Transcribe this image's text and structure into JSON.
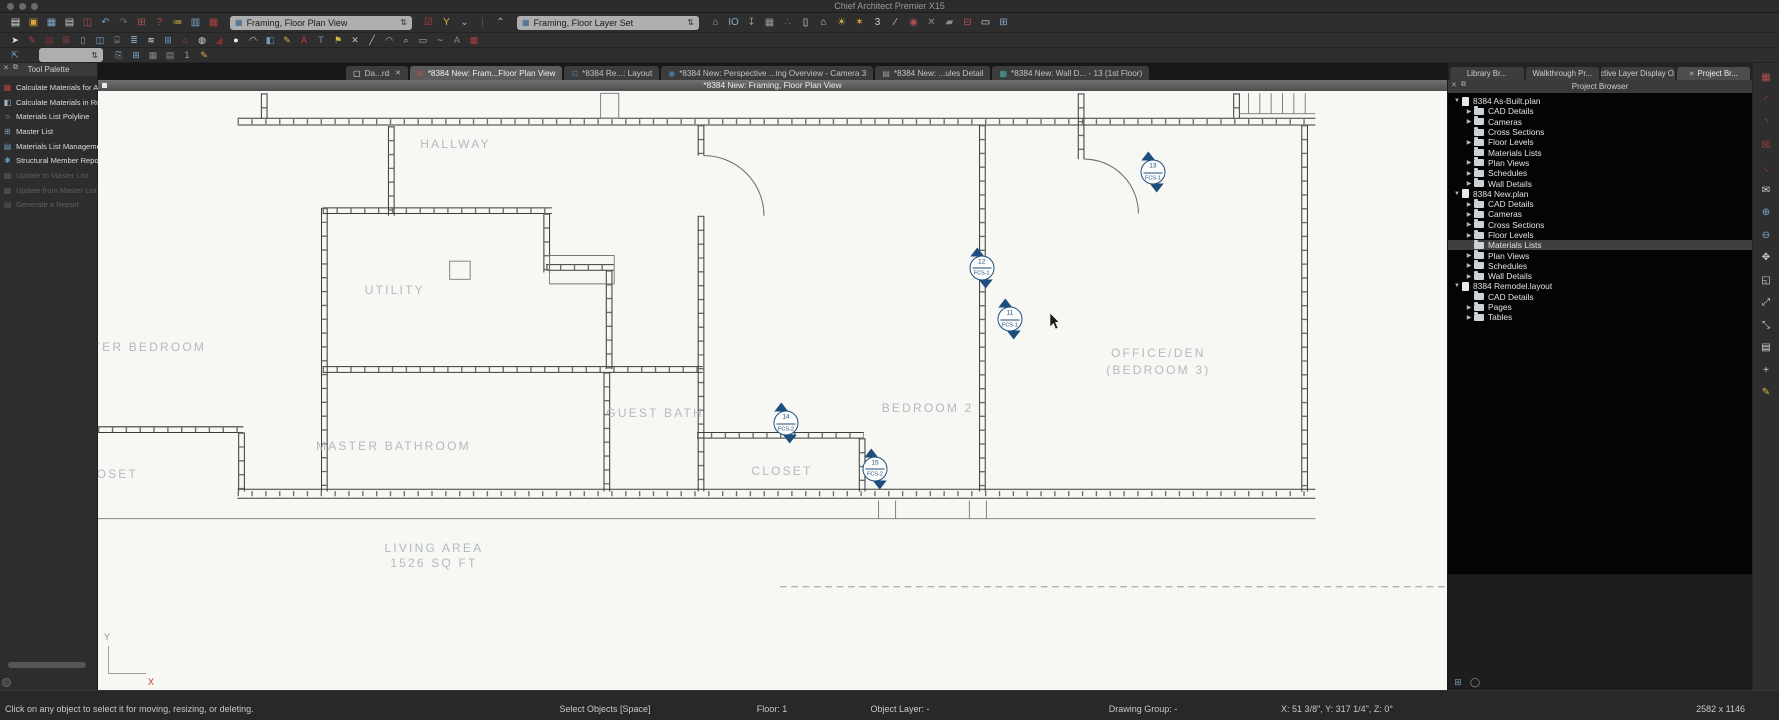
{
  "window": {
    "title": "Chief Architect Premier X15"
  },
  "toolbar": {
    "plan_view_select": "Framing, Floor Plan View",
    "layer_set_select": "Framing, Floor Layer Set",
    "row1a": [
      {
        "n": "new-plan-icon",
        "c": "#e6e6e6",
        "g": "▤"
      },
      {
        "n": "open-plan-icon",
        "c": "#d9a33c",
        "g": "▣"
      },
      {
        "n": "save-icon",
        "c": "#7fa8c9",
        "g": "▦"
      },
      {
        "n": "print-icon",
        "c": "#c9c9c9",
        "g": "▤"
      },
      {
        "n": "export-dialog-icon",
        "c": "#b05050",
        "g": "◫"
      },
      {
        "n": "undo-icon",
        "c": "#6f9cbf",
        "g": "↶"
      },
      {
        "n": "redo-icon",
        "c": "#6b6b6b",
        "g": "↷"
      },
      {
        "n": "layout-pages-icon",
        "c": "#b05050",
        "g": "⊞"
      },
      {
        "n": "help-icon",
        "c": "#c04040",
        "g": "?"
      },
      {
        "n": "materials-list-icon",
        "c": "#d9b44a",
        "g": "≔"
      },
      {
        "n": "components-icon",
        "c": "#7fa8c9",
        "g": "▥"
      },
      {
        "n": "ruby-report-icon",
        "c": "#b04040",
        "g": "▦"
      }
    ],
    "row1b": [
      {
        "n": "plan-check-icon",
        "c": "#c04040",
        "g": "☑"
      },
      {
        "n": "settings-wrench-icon",
        "c": "#d9b44a",
        "g": "Y"
      },
      {
        "n": "chevron-down-icon",
        "c": "#9fb6c9",
        "g": "⌄"
      },
      {
        "n": "toolbar-divider",
        "c": "#555555",
        "g": "|"
      },
      {
        "n": "chevron-up-icon",
        "c": "#9fb6c9",
        "g": "⌃"
      }
    ],
    "row1c": [
      {
        "n": "reference-display-icon",
        "c": "#7fa8c9",
        "g": "⌂"
      },
      {
        "n": "io-display-icon",
        "c": "#7fa8c9",
        "g": "IO"
      },
      {
        "n": "import-tray-icon",
        "c": "#9a9a9a",
        "g": "↧"
      },
      {
        "n": "building-icon",
        "c": "#9a9a9a",
        "g": "▦"
      },
      {
        "n": "walkthrough-icon",
        "c": "#4a7fa5",
        "g": "∴"
      },
      {
        "n": "column-icon",
        "c": "#dddddd",
        "g": "▯"
      },
      {
        "n": "home-view-icon",
        "c": "#cccccc",
        "g": "⌂"
      },
      {
        "n": "light-on-icon",
        "c": "#d9b44a",
        "g": "☀"
      },
      {
        "n": "light-burst-icon",
        "c": "#d9a33c",
        "g": "✶"
      },
      {
        "n": "three-d-icon",
        "c": "#cccccc",
        "g": "3"
      },
      {
        "n": "section-line-icon",
        "c": "#cccccc",
        "g": "∕"
      },
      {
        "n": "render-camera-icon",
        "c": "#b05050",
        "g": "◉"
      },
      {
        "n": "delete-view-icon",
        "c": "#8a8a8a",
        "g": "✕"
      },
      {
        "n": "eraser-icon",
        "c": "#8a8a8a",
        "g": "▰"
      },
      {
        "n": "schedule-grid-icon",
        "c": "#b05050",
        "g": "⊟"
      },
      {
        "n": "picture-icon",
        "c": "#dddddd",
        "g": "▭"
      },
      {
        "n": "tile-windows-icon",
        "c": "#7fa8c9",
        "g": "⊞"
      }
    ],
    "row2": [
      {
        "n": "select-arrow-icon",
        "c": "#e8e8e8",
        "g": "➤"
      },
      {
        "n": "framing-tool-icon",
        "c": "#b04040",
        "g": "✎"
      },
      {
        "n": "wall-tool-icon",
        "c": "#8a2f2f",
        "g": "▤"
      },
      {
        "n": "framing-x-icon",
        "c": "#b04040",
        "g": "☒"
      },
      {
        "n": "column-tool-icon",
        "c": "#7fa8c9",
        "g": "▯"
      },
      {
        "n": "door-tool-icon",
        "c": "#7fa8c9",
        "g": "◫"
      },
      {
        "n": "cabinet-tool-icon",
        "c": "#9a9a9a",
        "g": "⌸"
      },
      {
        "n": "list-tool-icon",
        "c": "#7fa8c9",
        "g": "≣"
      },
      {
        "n": "layers-icon",
        "c": "#dddddd",
        "g": "≋"
      },
      {
        "n": "window-tool-icon",
        "c": "#6f9cbf",
        "g": "⊞"
      },
      {
        "n": "house-tool-icon",
        "c": "#b04040",
        "g": "⌂"
      },
      {
        "n": "lamp-tool-icon",
        "c": "#dddddd",
        "g": "◍"
      },
      {
        "n": "roof-tool-icon",
        "c": "#8a2f2f",
        "g": "◢"
      },
      {
        "n": "material-blob-icon",
        "c": "#eeeeee",
        "g": "●"
      },
      {
        "n": "awning-tool-icon",
        "c": "#dddddd",
        "g": "◠"
      },
      {
        "n": "cube-tool-icon",
        "c": "#6f9cbf",
        "g": "◧"
      },
      {
        "n": "pencil-tool-icon",
        "c": "#d9b44a",
        "g": "✎"
      },
      {
        "n": "text-red-icon",
        "c": "#c04040",
        "g": "A"
      },
      {
        "n": "text-blue-icon",
        "c": "#6f9cbf",
        "g": "T"
      },
      {
        "n": "flag-tool-icon",
        "c": "#d9b44a",
        "g": "⚑"
      },
      {
        "n": "delete-tool-icon",
        "c": "#bbbbbb",
        "g": "✕"
      },
      {
        "n": "line-tool-icon",
        "c": "#bbbbbb",
        "g": "╱"
      },
      {
        "n": "arc-tool-icon",
        "c": "#bbbbbb",
        "g": "◠"
      },
      {
        "n": "zoom-tool-icon",
        "c": "#bbbbbb",
        "g": "⌕"
      },
      {
        "n": "marquee-tool-icon",
        "c": "#bbbbbb",
        "g": "▭"
      },
      {
        "n": "polyline-tool-icon",
        "c": "#bbbbbb",
        "g": "~"
      },
      {
        "n": "annotate-tool-icon",
        "c": "#8a8a8a",
        "g": "A"
      },
      {
        "n": "cad-detail-icon",
        "c": "#b04040",
        "g": "▦"
      }
    ],
    "row3a": [
      {
        "n": "transform-replicate-icon",
        "c": "#7fa8c9",
        "g": "⇱"
      }
    ],
    "row3b": [
      {
        "n": "copy-icon",
        "c": "#7fa8c9",
        "g": "⎘"
      },
      {
        "n": "table-icon",
        "c": "#7fa8c9",
        "g": "⊞"
      },
      {
        "n": "grid-a-icon",
        "c": "#8a8a8a",
        "g": "▦"
      },
      {
        "n": "grid-b-icon",
        "c": "#8a8a8a",
        "g": "▤"
      },
      {
        "n": "one-icon",
        "c": "#9a9a9a",
        "g": "1"
      },
      {
        "n": "report-edit-icon",
        "c": "#d9b44a",
        "g": "✎"
      }
    ]
  },
  "tool_palette": {
    "title": "Tool Palette",
    "items": [
      {
        "label": "Calculate Materials for All Floors",
        "enabled": true,
        "icon": {
          "n": "calc-materials-all-floors-icon",
          "c": "#c04040",
          "g": "▦"
        }
      },
      {
        "label": "Calculate Materials in Room",
        "enabled": true,
        "icon": {
          "n": "calc-materials-room-icon",
          "c": "#9fb6c9",
          "g": "◧"
        }
      },
      {
        "label": "Materials List Polyline",
        "enabled": true,
        "icon": {
          "n": "materials-polyline-icon",
          "c": "#aaaaaa",
          "g": "○"
        }
      },
      {
        "label": "Master List",
        "enabled": true,
        "icon": {
          "n": "master-list-icon",
          "c": "#6f9cbf",
          "g": "⊞"
        }
      },
      {
        "label": "Materials List Management",
        "enabled": true,
        "icon": {
          "n": "materials-management-icon",
          "c": "#6f9cbf",
          "g": "▤"
        }
      },
      {
        "label": "Structural Member Reporting",
        "enabled": true,
        "icon": {
          "n": "structural-reporting-icon",
          "c": "#5f9cb0",
          "g": "✱"
        }
      },
      {
        "label": "Update to Master List",
        "enabled": false,
        "icon": {
          "n": "update-to-master-icon",
          "c": "#5a5a5a",
          "g": "▦"
        }
      },
      {
        "label": "Update from Master List",
        "enabled": false,
        "icon": {
          "n": "update-from-master-icon",
          "c": "#5a5a5a",
          "g": "▦"
        }
      },
      {
        "label": "Generate a Report",
        "enabled": false,
        "icon": {
          "n": "generate-report-icon",
          "c": "#5a5a5a",
          "g": "▤"
        }
      }
    ]
  },
  "tabs": [
    {
      "label": "Da...rd",
      "active": false,
      "closable": true,
      "icon": {
        "n": "dashboard-doc-icon",
        "c": "#e8e8e8",
        "g": "▢"
      }
    },
    {
      "label": "*8384 New: Fram...Floor Plan View",
      "active": true,
      "closable": false,
      "icon": {
        "n": "plan-view-tab-icon",
        "c": "#b05050",
        "g": "⊞"
      }
    },
    {
      "label": "*8384 Re...: Layout",
      "active": false,
      "closable": false,
      "icon": {
        "n": "layout-tab-icon",
        "c": "#4a7fa5",
        "g": "⊡"
      }
    },
    {
      "label": "*8384 New: Perspective ...ing Overview - Camera 3",
      "active": false,
      "closable": false,
      "icon": {
        "n": "camera-tab-icon",
        "c": "#4a7fa5",
        "g": "◉"
      }
    },
    {
      "label": "*8384 New: ...ules Detail",
      "active": false,
      "closable": false,
      "icon": {
        "n": "detail-tab-icon",
        "c": "#9a9a9a",
        "g": "▤"
      }
    },
    {
      "label": "*8384 New: Wall D... - 13 (1st Floor)",
      "active": false,
      "closable": false,
      "icon": {
        "n": "wall-detail-tab-icon",
        "c": "#4aa5a0",
        "g": "▦"
      }
    }
  ],
  "view_title": "*8384 New: Framing, Floor Plan View",
  "canvas": {
    "rooms": [
      {
        "label": "HALLWAY",
        "x": 26.5,
        "y": 8.9
      },
      {
        "label": "UTILITY",
        "x": 22.0,
        "y": 33.3
      },
      {
        "label": "MASTER BEDROOM",
        "x": 2.6,
        "y": 42.8
      },
      {
        "label": "GUEST BATH",
        "x": 41.3,
        "y": 53.8
      },
      {
        "label": "MASTER BATHROOM",
        "x": 21.9,
        "y": 59.3
      },
      {
        "label": "CLOSET",
        "x": 0.7,
        "y": 64.0
      },
      {
        "label": "CLOSET",
        "x": 50.7,
        "y": 63.4
      },
      {
        "label": "BEDROOM 2",
        "x": 61.5,
        "y": 53.0
      },
      {
        "label": "OFFICE/DEN",
        "x": 78.6,
        "y": 43.8
      },
      {
        "label": "(BEDROOM 3)",
        "x": 78.6,
        "y": 46.6
      },
      {
        "label": "LIVING AREA",
        "x": 24.9,
        "y": 76.3
      },
      {
        "label": "1526 SQ FT",
        "x": 24.9,
        "y": 78.8
      }
    ],
    "markers": [
      {
        "num": "13",
        "code": "FCS-1",
        "x": 78.2,
        "y": 13.6
      },
      {
        "num": "12",
        "code": "FCS-1",
        "x": 65.5,
        "y": 29.5
      },
      {
        "num": "11",
        "code": "FCS-1",
        "x": 67.6,
        "y": 38.1
      },
      {
        "num": "14",
        "code": "FCS-2",
        "x": 51.0,
        "y": 55.5
      },
      {
        "num": "15",
        "code": "FCS-2",
        "x": 57.6,
        "y": 63.1
      }
    ],
    "axis": {
      "x": "X",
      "y": "Y"
    }
  },
  "project_browser": {
    "panel_tabs": [
      {
        "label": "Library Br...",
        "active": false,
        "closable": false
      },
      {
        "label": "Walkthrough Pr...",
        "active": false,
        "closable": false
      },
      {
        "label": "Active Layer Display O...",
        "active": false,
        "closable": false
      },
      {
        "label": "Project Br...",
        "active": true,
        "closable": true
      }
    ],
    "title": "Project Browser",
    "tree": [
      {
        "label": "8384 As-Built.plan",
        "children": [
          {
            "label": "CAD Details",
            "arrow": true
          },
          {
            "label": "Cameras",
            "arrow": true
          },
          {
            "label": "Cross Sections",
            "arrow": false
          },
          {
            "label": "Floor Levels",
            "arrow": true
          },
          {
            "label": "Materials Lists",
            "arrow": false
          },
          {
            "label": "Plan Views",
            "arrow": true
          },
          {
            "label": "Schedules",
            "arrow": true
          },
          {
            "label": "Wall Details",
            "arrow": true
          }
        ]
      },
      {
        "label": "8384 New.plan",
        "children": [
          {
            "label": "CAD Details",
            "arrow": true
          },
          {
            "label": "Cameras",
            "arrow": true
          },
          {
            "label": "Cross Sections",
            "arrow": true
          },
          {
            "label": "Floor Levels",
            "arrow": true
          },
          {
            "label": "Materials Lists",
            "arrow": false,
            "selected": true
          },
          {
            "label": "Plan Views",
            "arrow": true
          },
          {
            "label": "Schedules",
            "arrow": true
          },
          {
            "label": "Wall Details",
            "arrow": true
          }
        ]
      },
      {
        "label": "8384 Remodel.layout",
        "children": [
          {
            "label": "CAD Details",
            "arrow": false
          },
          {
            "label": "Pages",
            "arrow": true
          },
          {
            "label": "Tables",
            "arrow": true
          }
        ]
      }
    ],
    "foot_icons": [
      {
        "n": "panel-grid-icon",
        "c": "#6f9cbf",
        "g": "⊞"
      },
      {
        "n": "panel-circle-icon",
        "c": "#9a9a9a",
        "g": "◯"
      }
    ]
  },
  "right_strip_icons": [
    {
      "n": "framing-strip-icon",
      "c": "#b05050",
      "g": "▦"
    },
    {
      "n": "arc-strip-1-icon",
      "c": "#b04040",
      "g": "◜"
    },
    {
      "n": "arc-strip-2-icon",
      "c": "#b04040",
      "g": "◝"
    },
    {
      "n": "doc-delete-strip-icon",
      "c": "#b04040",
      "g": "☒"
    },
    {
      "n": "arc-strip-3-icon",
      "c": "#b04040",
      "g": "◟"
    },
    {
      "n": "comment-strip-icon",
      "c": "#cfd6da",
      "g": "✉"
    },
    {
      "n": "zoom-in-strip-icon",
      "c": "#7fa8c9",
      "g": "⊕"
    },
    {
      "n": "zoom-out-strip-icon",
      "c": "#7fa8c9",
      "g": "⊖"
    },
    {
      "n": "pan-strip-icon",
      "c": "#cfd6da",
      "g": "✥"
    },
    {
      "n": "fill-window-strip-icon",
      "c": "#cfd6da",
      "g": "◱"
    },
    {
      "n": "expand-strip-icon",
      "c": "#cfd6da",
      "g": "⤢"
    },
    {
      "n": "shrink-strip-icon",
      "c": "#cfd6da",
      "g": "⤡"
    },
    {
      "n": "print-preview-strip-icon",
      "c": "#cfd6da",
      "g": "▤"
    },
    {
      "n": "crosshair-strip-icon",
      "c": "#cfd6da",
      "g": "+"
    },
    {
      "n": "export-strip-icon",
      "c": "#d9b44a",
      "g": "✎"
    }
  ],
  "status_bar": {
    "hint": "Click on any object to select it for moving, resizing, or deleting.",
    "mode": "Select Objects [Space]",
    "floor": "Floor: 1",
    "object_layer": "Object Layer: -",
    "drawing_group": "Drawing Group: -",
    "coords": "X: 51 3/8\", Y: 317 1/4\", Z: 0°",
    "resolution": "2582 x 1146"
  }
}
